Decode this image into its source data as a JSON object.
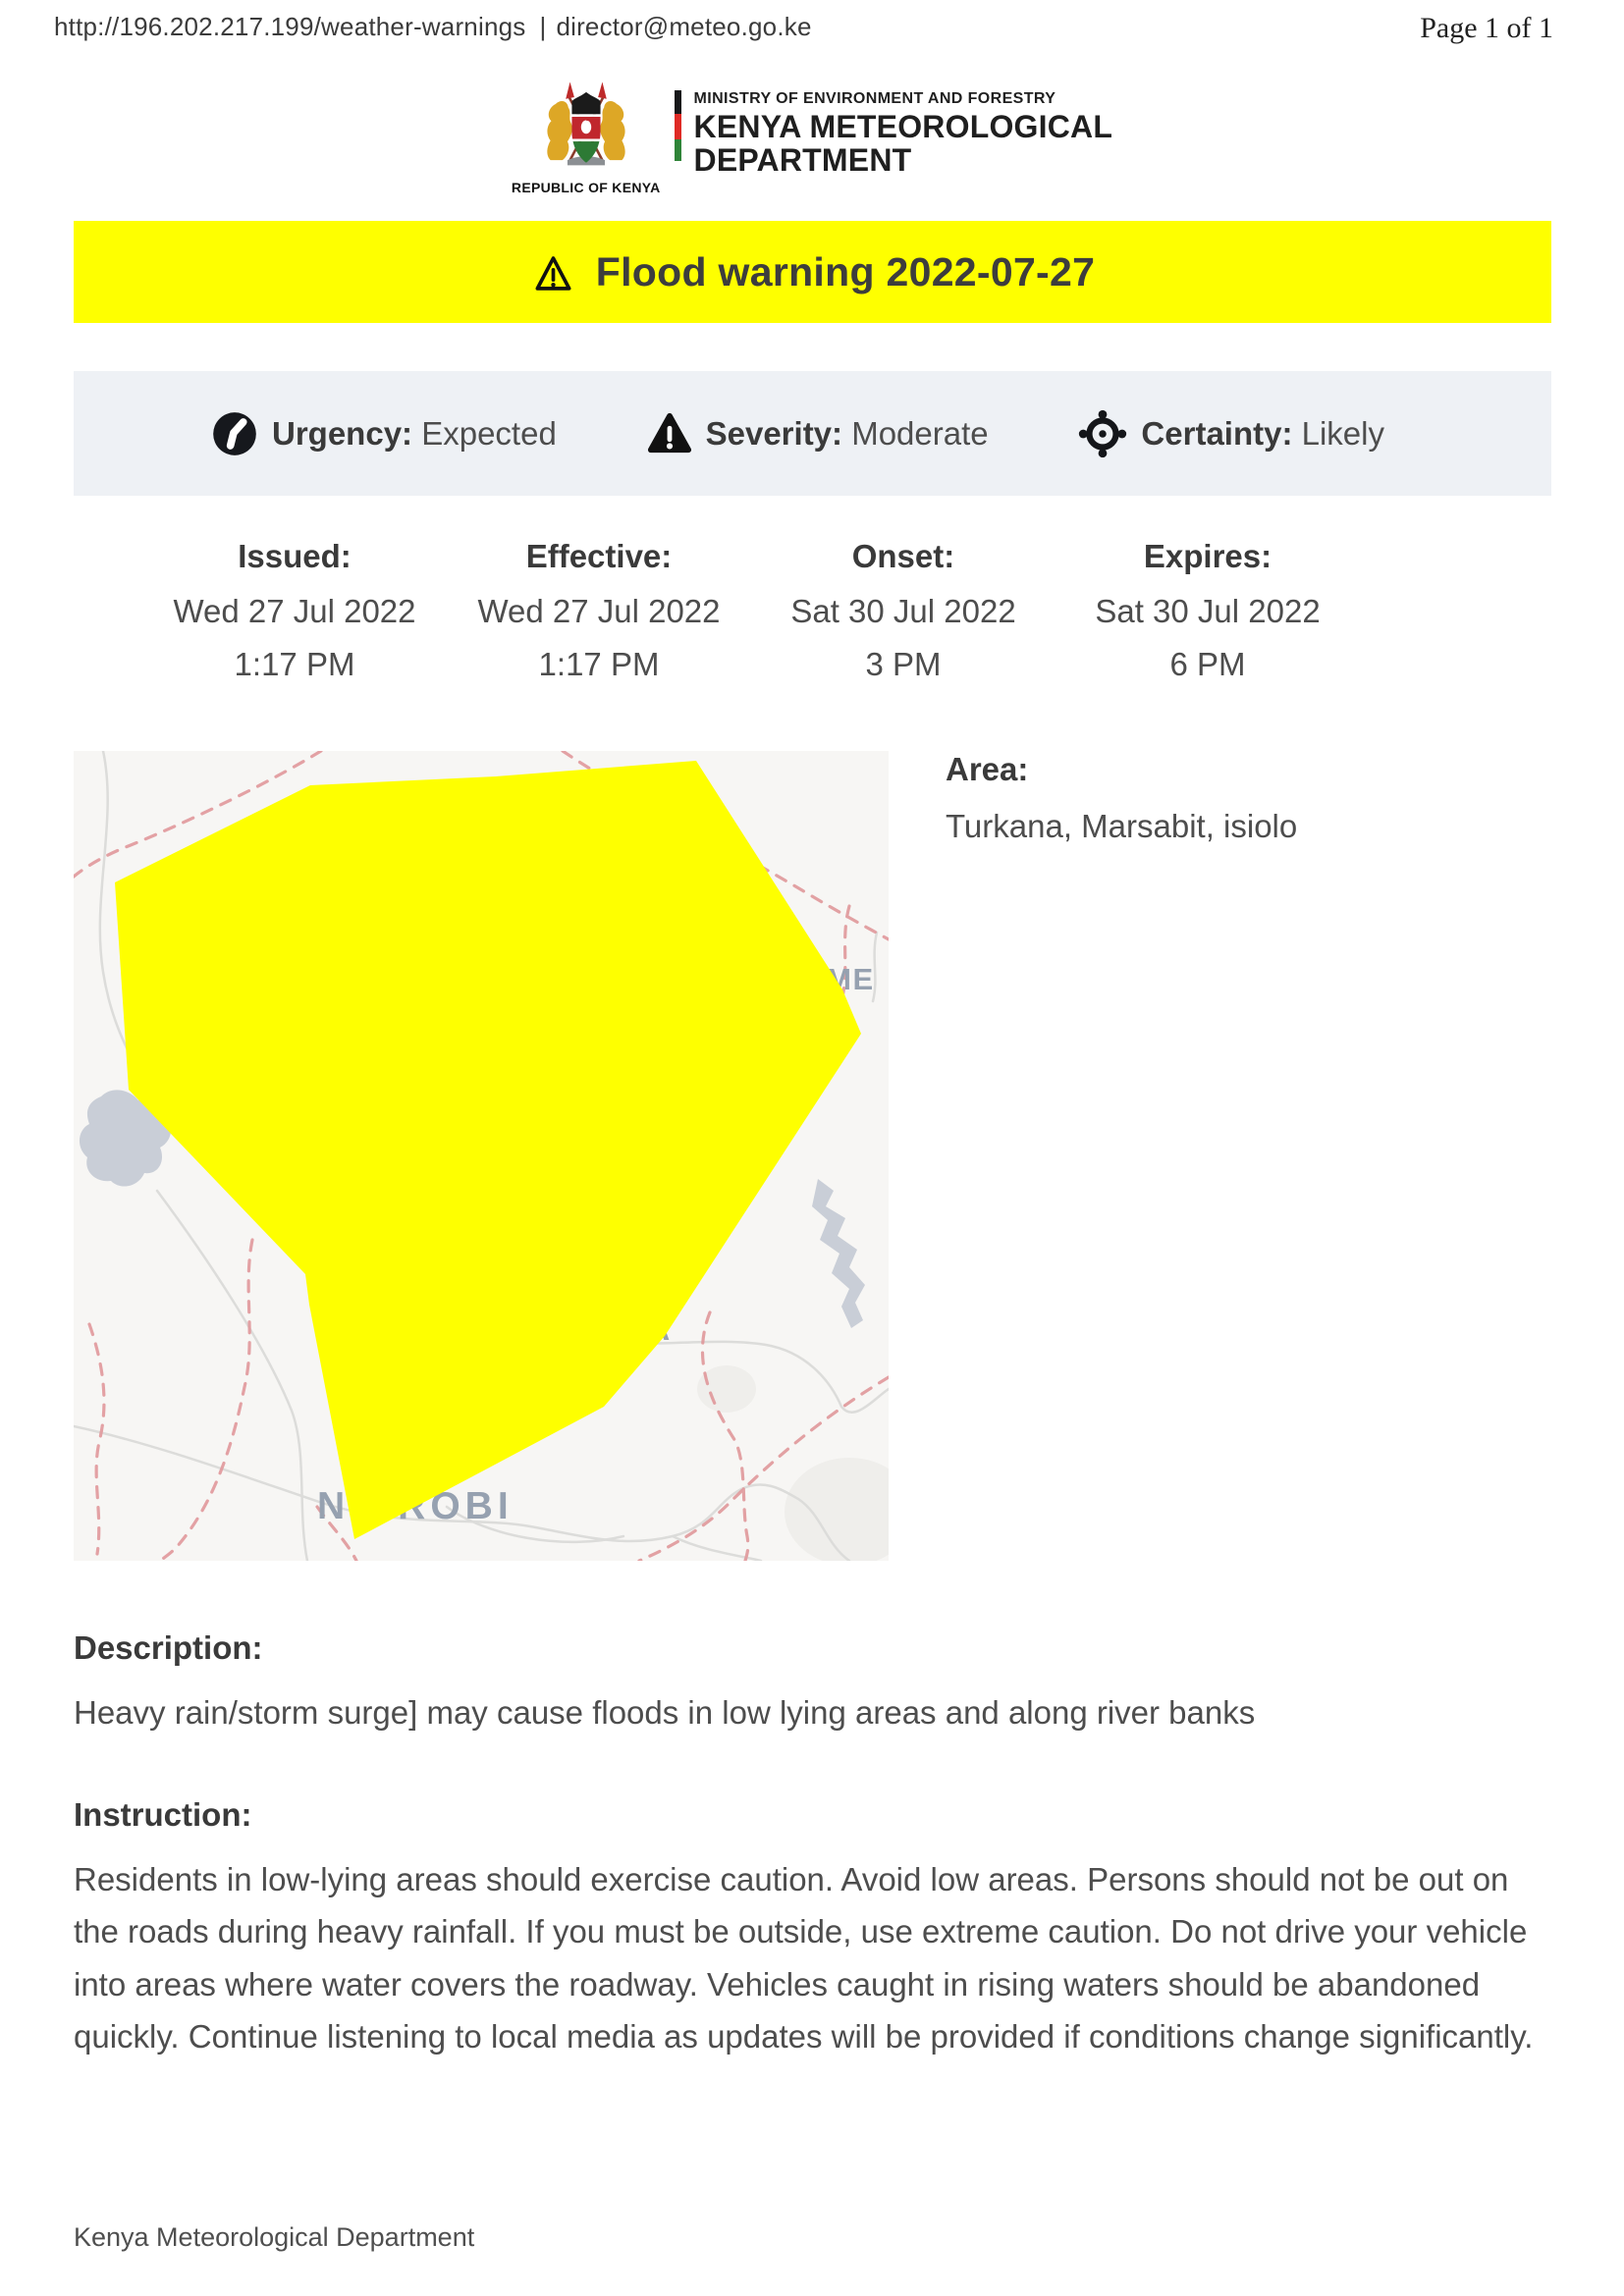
{
  "header": {
    "url": "http://196.202.217.199/weather-warnings",
    "separator": "|",
    "email": "director@meteo.go.ke",
    "page_label": "Page 1 of 1"
  },
  "logo": {
    "caption": "REPUBLIC OF KENYA",
    "ministry": "MINISTRY OF ENVIRONMENT AND FORESTRY",
    "org_line1": "KENYA METEOROLOGICAL",
    "org_line2": "DEPARTMENT"
  },
  "banner": {
    "title": "Flood warning 2022-07-27"
  },
  "attributes": {
    "urgency_label": "Urgency:",
    "urgency_value": "Expected",
    "severity_label": "Severity:",
    "severity_value": "Moderate",
    "certainty_label": "Certainty:",
    "certainty_value": "Likely"
  },
  "dates": [
    {
      "label": "Issued:",
      "date": "Wed 27 Jul 2022",
      "time": "1:17 PM"
    },
    {
      "label": "Effective:",
      "date": "Wed 27 Jul 2022",
      "time": "1:17 PM"
    },
    {
      "label": "Onset:",
      "date": "Sat 30 Jul 2022",
      "time": "3 PM"
    },
    {
      "label": "Expires:",
      "date": "Sat 30 Jul 2022",
      "time": "6 PM"
    }
  ],
  "area": {
    "label": "Area:",
    "value": "Turkana, Marsabit, isiolo"
  },
  "map": {
    "polygon_color": "#FEFF00",
    "labels": {
      "east_partial": "EME",
      "county_partial": "A",
      "city": "NAIROBI"
    }
  },
  "description": {
    "label": "Description:",
    "text": "Heavy rain/storm surge] may cause floods in low lying areas and along river banks"
  },
  "instruction": {
    "label": "Instruction:",
    "text": "Residents in low-lying areas should exercise caution. Avoid low areas. Persons should not be out on the roads during heavy rainfall. If you must be outside, use extreme caution. Do not drive your vehicle into areas where water covers the roadway. Vehicles caught in rising waters should be abandoned quickly. Continue listening to local media as updates will be provided if conditions change significantly."
  },
  "footer": {
    "text": "Kenya Meteorological Department"
  },
  "colors": {
    "warning_yellow": "#FEFF00",
    "attribute_bar_bg": "#EEF1F5",
    "map_background": "#F7F6F4",
    "boundary_dash_pink": "#E0989B",
    "map_label_gray": "#96A1B0",
    "water_gray": "#C9CED7"
  }
}
